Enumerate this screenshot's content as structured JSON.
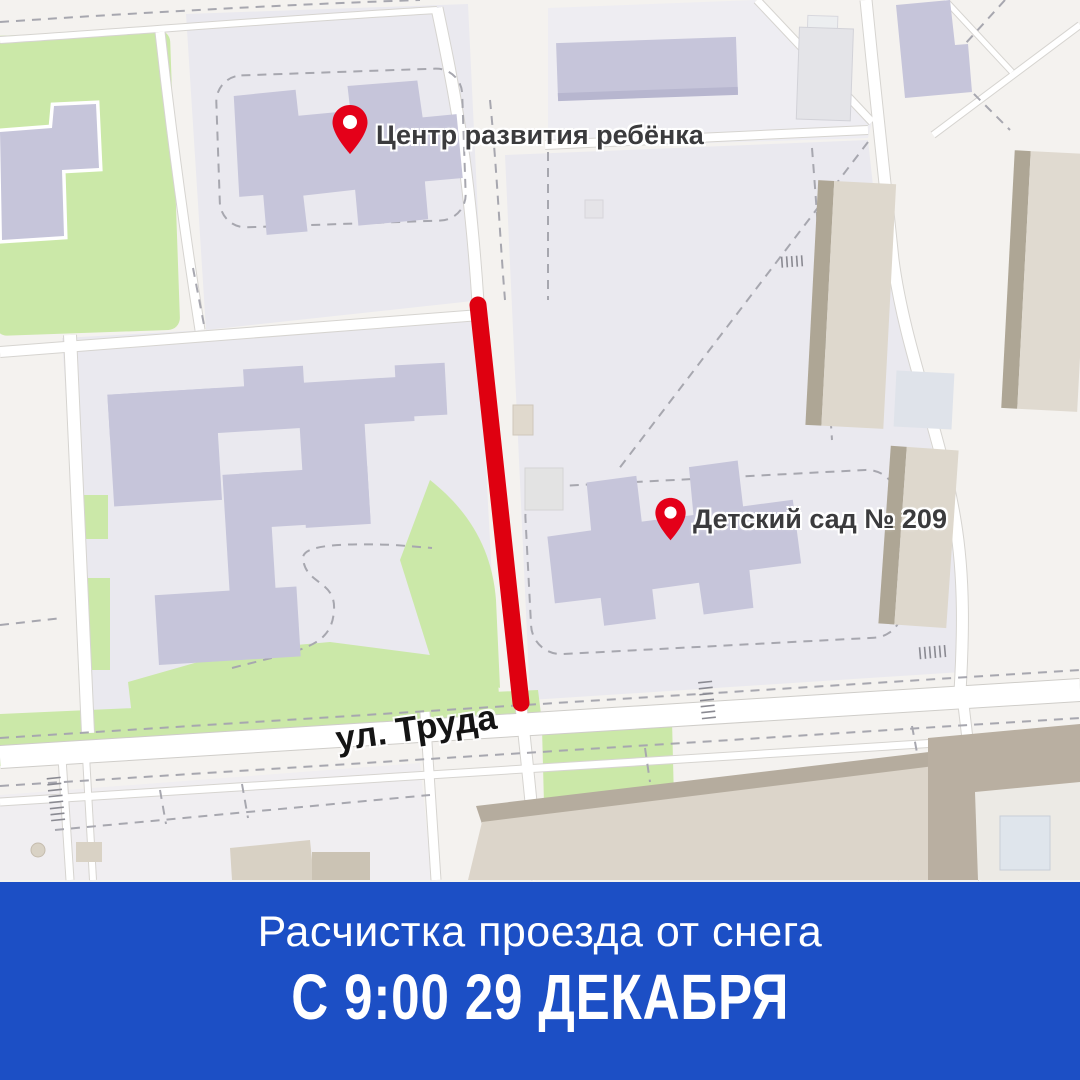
{
  "map": {
    "markers": [
      {
        "label": "Центр развития ребёнка"
      },
      {
        "label": "Детский сад № 209"
      }
    ],
    "street_label": "ул. Труда",
    "colors": {
      "closure_line": "#df0010",
      "pin": "#e40019",
      "map_background": "#f4f2ef",
      "block_fill": "#eae9ef",
      "building_lavender": "#c6c5da",
      "building_beige": "#ded8cd",
      "building_beige_dark": "#aea695",
      "green_area": "#cbe8a8",
      "marker_label_text": "#3b3b3d",
      "street_label_text": "#141414"
    }
  },
  "banner": {
    "line1": "Расчистка проезда от снега",
    "line2": "С 9:00 29 ДЕКАБРЯ",
    "background": "#1c4fc5",
    "text_color": "#ffffff"
  }
}
